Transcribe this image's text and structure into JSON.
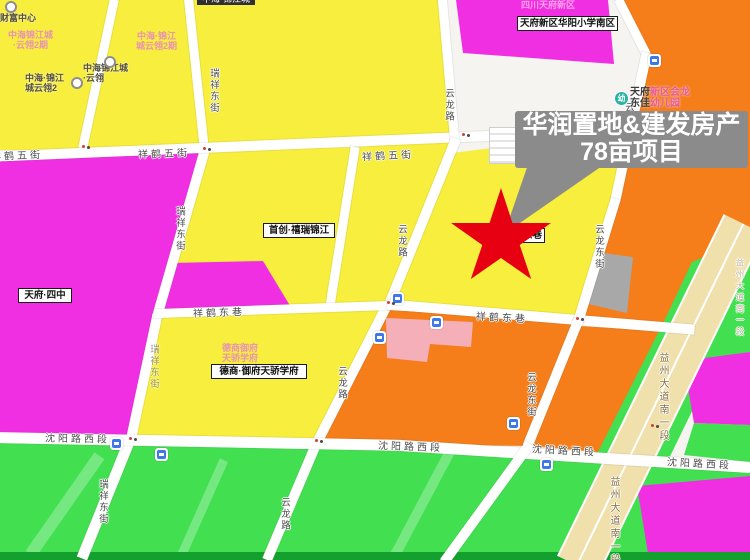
{
  "callout": {
    "line1": "华润置地&建发房产",
    "line2": "78亩项目"
  },
  "top_clipped_label": {
    "text": "中海·锦江城"
  },
  "kindergarten": {
    "l1_dark": "天府",
    "l1_pink": "新区会龙",
    "l2_dark": "东佳",
    "l2_pink": "幼儿园",
    "icon_glyph": "幼"
  },
  "boxed_labels": [
    {
      "name": "school-south-label",
      "text": "天府新区华阳小学南区",
      "x": 517,
      "y": 16,
      "w": 95
    },
    {
      "name": "tianfu-no4-label",
      "text": "天府·四中",
      "x": 18,
      "y": 288,
      "w": 48
    },
    {
      "name": "shouchuang-label",
      "text": "首创·禧瑞锦江",
      "x": 263,
      "y": 223,
      "w": 66
    },
    {
      "name": "deshang-label",
      "text": "德商·御府天骄学府",
      "x": 211,
      "y": 364,
      "w": 90
    },
    {
      "name": "covered-label",
      "text": "东巷",
      "x": 497,
      "y": 228,
      "w": 42,
      "align": "right"
    }
  ],
  "road_labels": [
    {
      "text": "祥鹤五街",
      "x": -9,
      "y": 147,
      "rot": -2
    },
    {
      "text": "祥鹤五街",
      "x": 138,
      "y": 145,
      "rot": -2
    },
    {
      "text": "祥鹤五街",
      "x": 362,
      "y": 147,
      "rot": -3
    },
    {
      "text": "祥鹤东巷",
      "x": 193,
      "y": 304,
      "rot": -2
    },
    {
      "text": "祥鹤东巷",
      "x": 476,
      "y": 309,
      "rot": 3
    },
    {
      "text": "沈阳路西段",
      "x": 45,
      "y": 430,
      "rot": 1
    },
    {
      "text": "沈阳路西段",
      "x": 378,
      "y": 438,
      "rot": 2
    },
    {
      "text": "沈阳路西段",
      "x": 532,
      "y": 442,
      "rot": 3
    },
    {
      "text": "沈阳路西段",
      "x": 667,
      "y": 455,
      "rot": 3
    },
    {
      "text": "瑞祥东街",
      "x": 206,
      "y": 68,
      "vert": true
    },
    {
      "text": "瑞祥东街",
      "x": 172,
      "y": 206,
      "vert": true
    },
    {
      "text": "瑞祥东街",
      "x": 146,
      "y": 344,
      "vert": true,
      "faint": true
    },
    {
      "text": "瑞祥东街",
      "x": 95,
      "y": 479,
      "vert": true
    },
    {
      "text": "云龙路",
      "x": 441,
      "y": 88,
      "vert": true
    },
    {
      "text": "云龙路",
      "x": 394,
      "y": 224,
      "vert": true
    },
    {
      "text": "云龙路",
      "x": 334,
      "y": 366,
      "vert": true
    },
    {
      "text": "云龙路",
      "x": 277,
      "y": 497,
      "vert": true
    },
    {
      "text": "云龙东街",
      "x": 621,
      "y": 102,
      "vert": true
    },
    {
      "text": "云龙东街",
      "x": 591,
      "y": 224,
      "vert": true
    },
    {
      "text": "云龙东街",
      "x": 523,
      "y": 372,
      "vert": true
    },
    {
      "text": "益州大道南一段",
      "x": 655,
      "y": 352,
      "vert": true,
      "cls": "avenue"
    },
    {
      "text": "益州大道南一段",
      "x": 606,
      "y": 476,
      "vert": true,
      "cls": "avenue"
    },
    {
      "text": "益州大道南一段",
      "x": 734,
      "y": 258,
      "vert": true,
      "cls": "avenue faintav"
    }
  ],
  "faint_labels": [
    {
      "lines": [
        "中海锦江城",
        "·云翎2期"
      ],
      "x": 8,
      "y": 30
    },
    {
      "lines": [
        "中海·锦江",
        "城云翎2期"
      ],
      "x": 136,
      "y": 31
    },
    {
      "lines": [
        "德商御府",
        "天骄学府"
      ],
      "x": 222,
      "y": 343
    },
    {
      "lines": [
        "四川天府新区"
      ],
      "x": 521,
      "y": 0,
      "cls": "onmagenta"
    }
  ],
  "poi_small_labels": [
    {
      "name": "wealth-center-poi",
      "lines": [
        "财富中心"
      ],
      "x": 0,
      "y": 13,
      "icon": [
        5,
        1
      ]
    },
    {
      "name": "zhonghai-yunling-poi-a",
      "lines": [
        "中海·锦江",
        "城云翎2"
      ],
      "x": 25,
      "y": 73,
      "icon": [
        71,
        77
      ]
    },
    {
      "name": "zhonghai-yunling-poi-b",
      "lines": [
        "中海锦江城",
        "·云翎"
      ],
      "x": 83,
      "y": 63,
      "icon": [
        104,
        56
      ]
    }
  ],
  "bus_stops": [
    [
      648,
      54
    ],
    [
      391,
      292
    ],
    [
      430,
      316
    ],
    [
      373,
      331
    ],
    [
      110,
      437
    ],
    [
      155,
      448
    ],
    [
      507,
      417
    ],
    [
      540,
      458
    ]
  ],
  "junctions": [
    [
      82,
      145
    ],
    [
      203,
      147
    ],
    [
      462,
      133
    ],
    [
      387,
      301
    ],
    [
      315,
      439
    ],
    [
      129,
      437
    ],
    [
      576,
      317
    ],
    [
      651,
      424
    ]
  ],
  "star": {
    "color": "#e60011"
  },
  "colors": {
    "parcel_yellow": "#f7ee3e",
    "parcel_magenta": "#f02fe2",
    "parcel_orange": "#f57d1a",
    "parcel_pink": "#f5afb9",
    "parcel_gray": "#a8a8a8",
    "park_green": "#42e051",
    "green_dark_edge": "#14a02e",
    "avenue_beige": "#f0e0ac",
    "road_white": "#ffffff",
    "callout_gray": "#8b8b8b",
    "star_red": "#e60011",
    "bus_icon_blue": "#3c78e8",
    "kindergarten_teal": "#2ab3a3"
  }
}
